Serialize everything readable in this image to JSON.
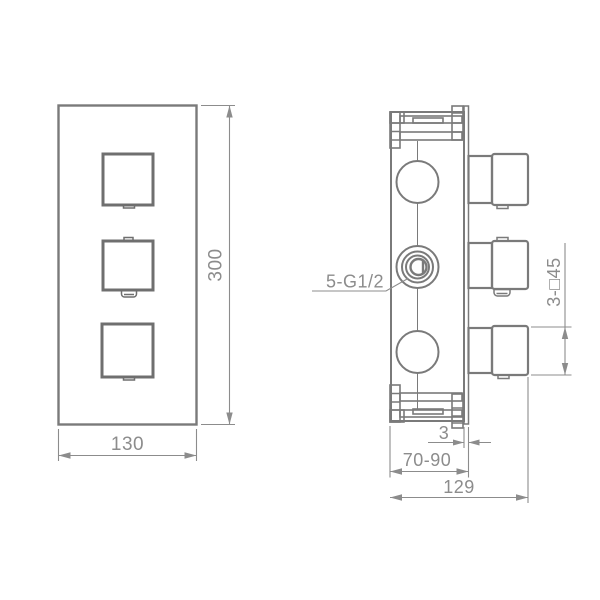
{
  "drawing": {
    "front_view": {
      "width_label": "130",
      "height_label": "300",
      "knob_count": 3
    },
    "side_view": {
      "ports_label": "5-G1/2",
      "handles_label": "3-□45",
      "plate_thickness_label": "3",
      "mounting_depth_label": "70-90",
      "total_depth_label": "129"
    },
    "colors": {
      "outline": "#7a7a7a",
      "heavy_outline": "#6f6f6f",
      "dimension": "#8c8c8c"
    }
  }
}
